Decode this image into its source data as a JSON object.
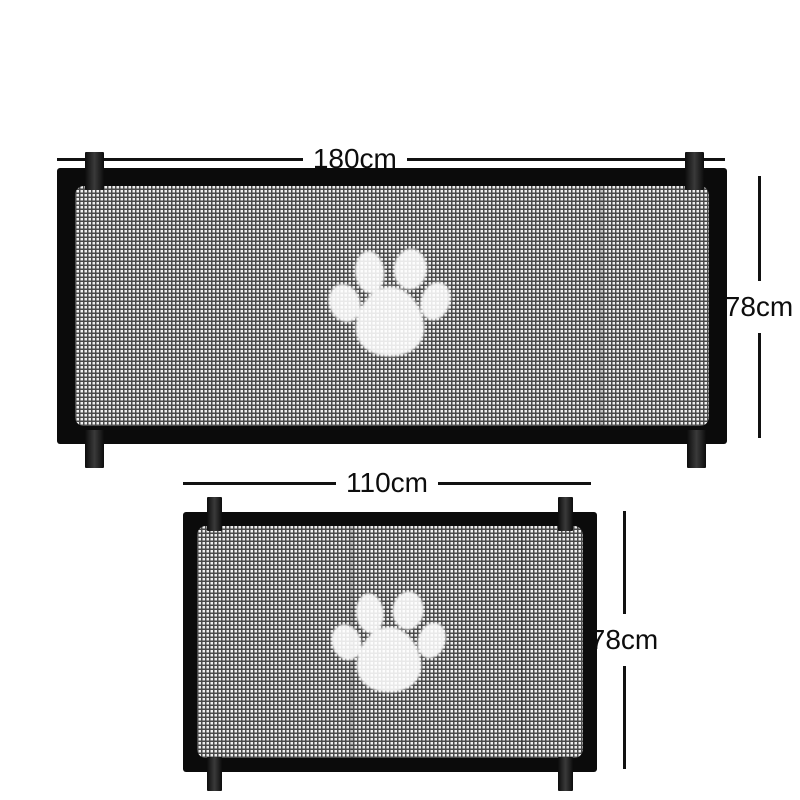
{
  "diagram": {
    "title": "pet-safety-gate-size-diagram",
    "gates": [
      {
        "name": "large-gate",
        "width_label": "180cm",
        "height_label": "78cm"
      },
      {
        "name": "small-gate",
        "width_label": "110cm",
        "height_label": "78cm"
      }
    ],
    "icons": {
      "paw": "paw-print-icon"
    },
    "colors": {
      "background": "#ffffff",
      "frame": "#0b0b0b",
      "strap": "#1d1d1d",
      "mesh_base": "#efefef",
      "mesh_line": "#4a4a4a",
      "dimension_line": "#111111",
      "paw": "#ffffff"
    }
  }
}
